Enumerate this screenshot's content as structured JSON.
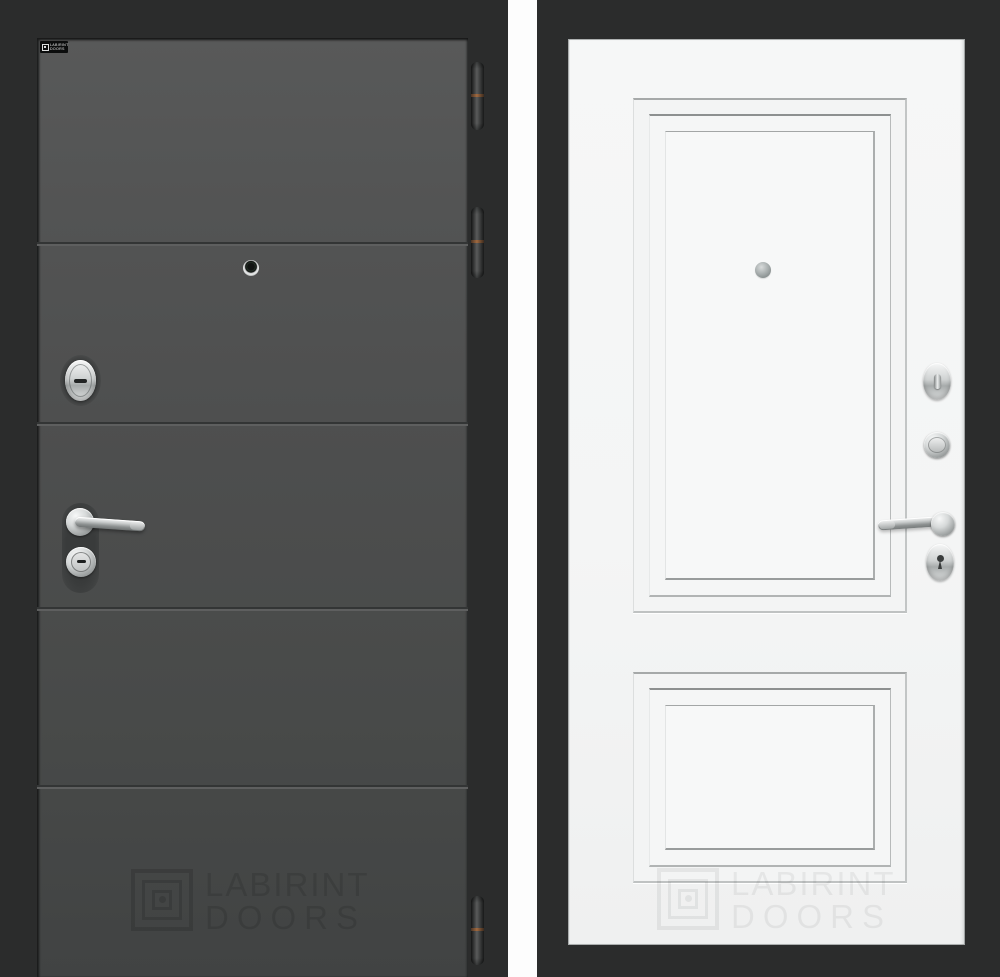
{
  "brand": {
    "line1": "LABIRINT",
    "line2": "DOORS"
  },
  "badge": {
    "line1": "LABIRINT",
    "line2": "DOORS"
  },
  "watermark_front": {
    "line1": "LABIRINT",
    "line2": "DOORS"
  },
  "watermark_back": {
    "line1": "LABIRINT",
    "line2": "DOORS"
  },
  "front_door": {
    "finish": "dark graphite with horizontal grooves",
    "groove_count": 4,
    "hinge_count": 3,
    "objects": [
      "brand-badge",
      "peephole",
      "cylinder-escutcheon",
      "lever-handle",
      "key-cylinder",
      "hinge",
      "watermark"
    ]
  },
  "back_door": {
    "finish": "white with two raised moulded panels",
    "panel_count": 2,
    "objects": [
      "peephole",
      "thumbturn-escutcheon",
      "round-cylinder",
      "lever-handle",
      "keyhole-escutcheon",
      "watermark"
    ]
  },
  "colors": {
    "frame_bg": "#2b2c2c",
    "divider": "#fdfdfd",
    "front_face_top": "#565757",
    "front_face_bottom": "#414343",
    "back_face": "#f4f5f5",
    "chrome_light": "#f6f7f7",
    "chrome_dark": "#8f9393",
    "hinge_copper": "#a06a40",
    "badge_bg": "#0c0d0d",
    "badge_text": "#e9eaea"
  }
}
